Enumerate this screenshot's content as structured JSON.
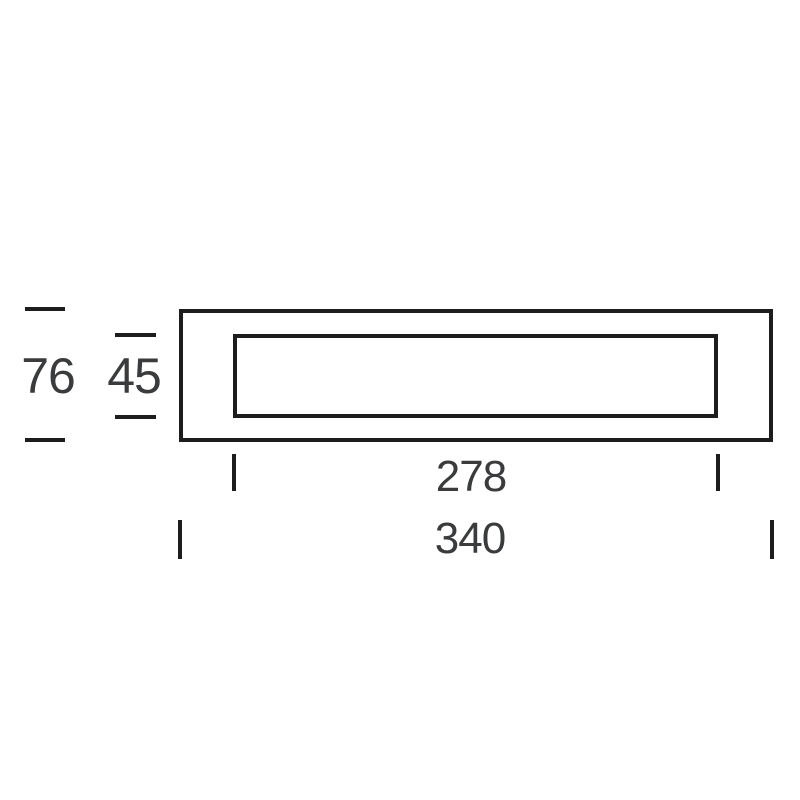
{
  "drawing": {
    "dimensions": {
      "overall_height": "76",
      "inner_height": "45",
      "inner_width": "278",
      "overall_width": "340"
    },
    "colors": {
      "line": "#1d1d1d",
      "text": "#3a3b3c",
      "background": "#ffffff"
    }
  }
}
